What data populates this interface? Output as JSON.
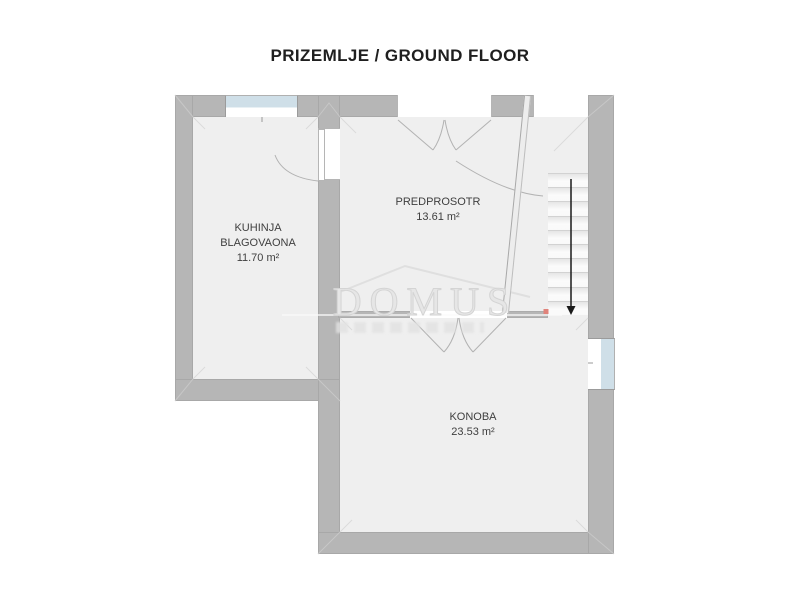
{
  "title": "PRIZEMLJE / GROUND FLOOR",
  "watermark": {
    "text": "DOMUS"
  },
  "rooms": {
    "kuhinja": {
      "name_line1": "KUHINJA",
      "name_line2": "BLAGOVAONA",
      "area": "11.70 m²"
    },
    "predprosotr": {
      "name": "PREDPROSOTR",
      "area": "13.61 m²"
    },
    "konoba": {
      "name": "KONOBA",
      "area": "23.53 m²"
    }
  },
  "stairs": {
    "steps": 10,
    "direction": "down"
  },
  "colors": {
    "wall": "#b6b6b6",
    "floor": "#efefef",
    "window_glass": "#cfdfe8",
    "wall_outline": "#a8a8a8",
    "watermark": "#dcdcdc",
    "marker": "#e0837b",
    "arrow": "#1a1a1a"
  }
}
